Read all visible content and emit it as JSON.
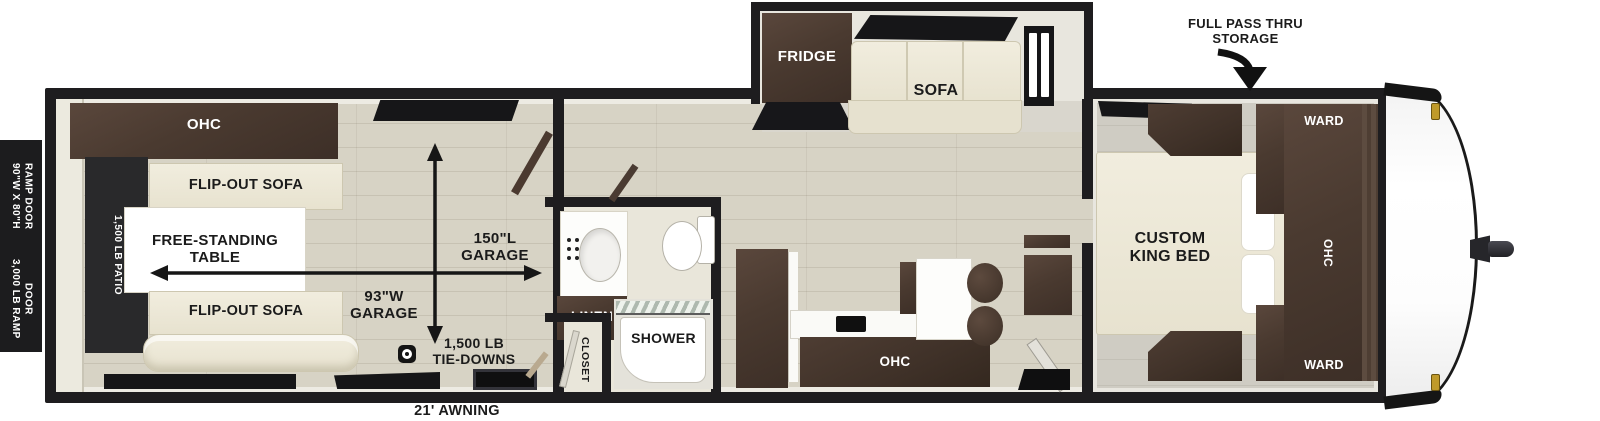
{
  "floorplan": {
    "exterior_labels": {
      "ramp_door_size": "90\"W X 80\"H\nRAMP DOOR",
      "ramp_door_rating": "3,000 LB RAMP\nDOOR",
      "pass_thru_storage": "FULL PASS THRU\nSTORAGE",
      "awning": "21' AWNING"
    },
    "garage": {
      "ohc": "OHC",
      "patio_rating": "1,500 LB PATIO",
      "flip_out_sofa_top": "FLIP-OUT SOFA",
      "flip_out_sofa_bottom": "FLIP-OUT SOFA",
      "free_standing_table": "FREE-STANDING\nTABLE",
      "garage_length": "150\"L\nGARAGE",
      "garage_width": "93\"W\nGARAGE",
      "tie_downs": "1,500 LB\nTIE-DOWNS"
    },
    "bathroom": {
      "linen": "LINEN",
      "shower": "SHOWER",
      "closet": "CLOSET"
    },
    "living_area": {
      "fridge": "FRIDGE",
      "sofa": "SOFA",
      "kitchen_ohc": "OHC"
    },
    "bedroom": {
      "bed": "CUSTOM\nKING BED",
      "wardrobe_top": "WARD",
      "ohc": "OHC",
      "wardrobe_bottom": "WARD"
    },
    "icons": {
      "tie_down_anchor": "ring-anchor-icon",
      "pass_thru_arrow": "curved-down-arrow-icon",
      "garage_length_arrow": "double-arrow-horizontal-icon",
      "garage_width_arrow": "double-arrow-vertical-icon"
    },
    "colors": {
      "wall": "#1e1d1f",
      "floor_wood": "#d7d3c5",
      "cabinet_wood": "#4a3a30",
      "upholstery_cream": "#ece8d8",
      "patio_dark": "#29292b",
      "marker_light_gold": "#c09a2a"
    }
  }
}
